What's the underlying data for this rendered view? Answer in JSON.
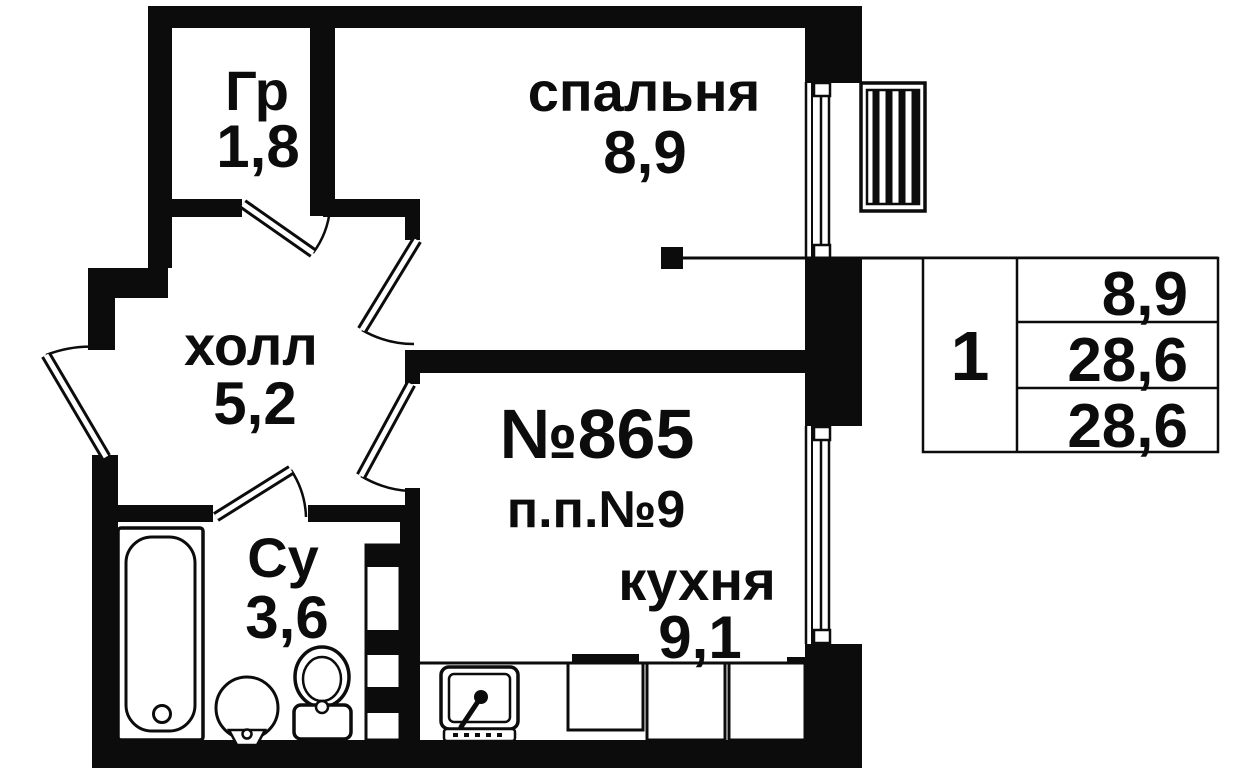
{
  "rooms": {
    "closet": {
      "name": "Гр",
      "area": "1,8"
    },
    "bedroom": {
      "name": "спальня",
      "area": "8,9"
    },
    "hall": {
      "name": "холл",
      "area": "5,2"
    },
    "bathroom": {
      "name": "Су",
      "area": "3,6"
    },
    "kitchen": {
      "name": "кухня",
      "area": "9,1"
    }
  },
  "apartment": {
    "number": "№865",
    "plan_note": "п.п.№9"
  },
  "summary_table": {
    "rooms_count": "1",
    "values": [
      "8,9",
      "28,6",
      "28,6"
    ]
  },
  "colors": {
    "ink": "#0c0c0c",
    "background": "#ffffff"
  }
}
